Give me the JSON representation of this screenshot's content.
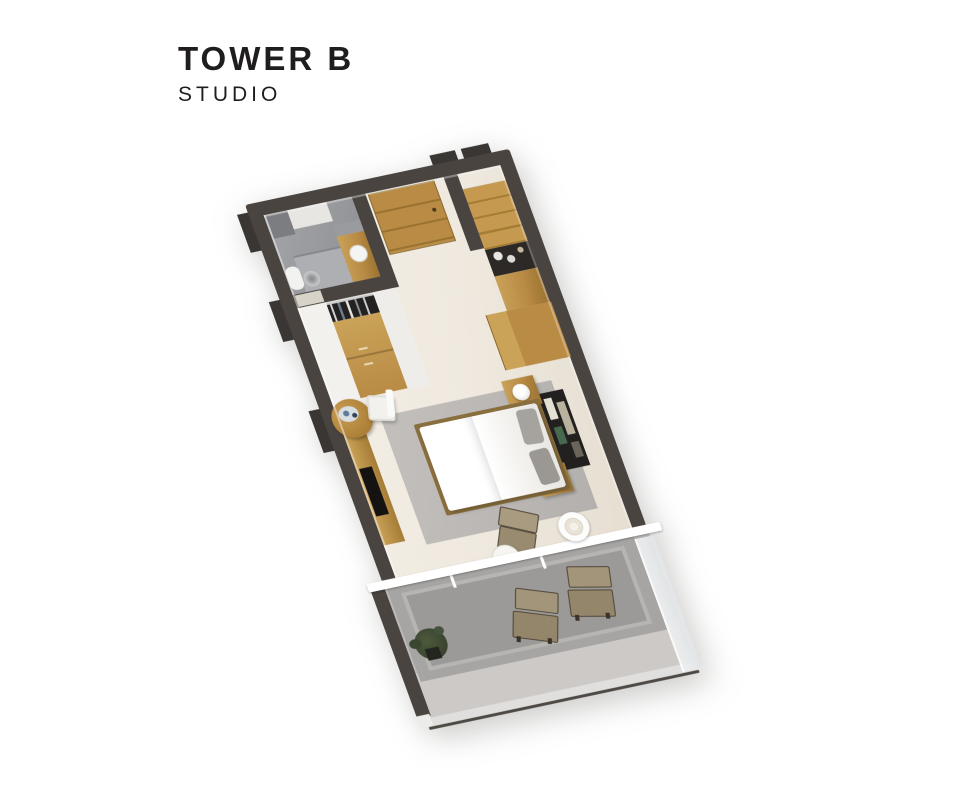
{
  "header": {
    "tower": "TOWER B",
    "unit_type": "STUDIO"
  },
  "colors": {
    "title": "#201d1d",
    "wall": "#4a4440",
    "wall-dark": "#3a3633",
    "floor": "#efe9df",
    "bath-floor": "#95969a",
    "wood": "#b98b45",
    "wood-dark": "#9a7230",
    "wood-light": "#caa258",
    "rug": "#bab7b4",
    "balcony": "#a7a5a3",
    "slab": "#c7c5c3",
    "chair": "#9d8f73",
    "chair-dark": "#4f4536",
    "plant": "#39422e",
    "glass": "#e3e6e8",
    "beam": "#ffffff"
  },
  "floorplan": {
    "style": "isometric 3d render, no text labels",
    "rooms": [
      "bathroom",
      "entry-hall",
      "kitchenette",
      "wardrobe",
      "studio-bedroom",
      "balcony"
    ],
    "furniture": [
      "entry-door",
      "shower",
      "toilet",
      "vanity-sink",
      "kitchen-cabinets",
      "cooktop",
      "pantry-cabinet",
      "wardrobe-sliding-doors",
      "clothes-rail",
      "round-table",
      "dining-chair",
      "tv-console",
      "tv",
      "area-rug",
      "double-bed",
      "pillows",
      "nightstands",
      "table-lamps",
      "wall-art-panels",
      "lounge-chair",
      "floor-lamp",
      "side-table",
      "sliding-window",
      "balcony-lounge-chairs",
      "potted-plant",
      "glass-railing"
    ]
  }
}
